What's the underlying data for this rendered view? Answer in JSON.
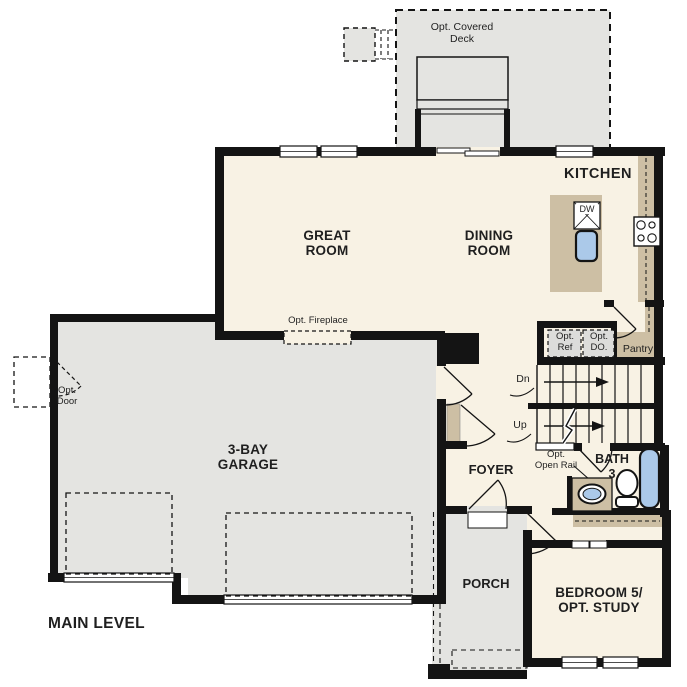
{
  "plan": {
    "level_title": "MAIN LEVEL",
    "labels": {
      "deck": "Opt. Covered\nDeck",
      "kitchen": "KITCHEN",
      "great_room": "GREAT\nROOM",
      "dining_room": "DINING\nROOM",
      "opt_fireplace": "Opt. Fireplace",
      "opt_ref": "Opt.\nRef",
      "opt_do": "Opt.\nDO.",
      "pantry": "Pantry",
      "stairs_down": "Dn",
      "stairs_up": "Up",
      "opt_door": "Opt.\nDoor",
      "garage": "3-BAY\nGARAGE",
      "foyer": "FOYER",
      "opt_open_rail": "Opt.\nOpen Rail",
      "bath3": "BATH\n3",
      "porch": "PORCH",
      "bedroom5": "BEDROOM 5/\nOPT. STUDY",
      "dishwasher": "DW"
    },
    "colors": {
      "wall": "#141414",
      "interior": "#f8f2e4",
      "exterior": "#e4e4e1",
      "counter": "#cdbfa4",
      "fixture_blue": "#abc9e9"
    }
  }
}
